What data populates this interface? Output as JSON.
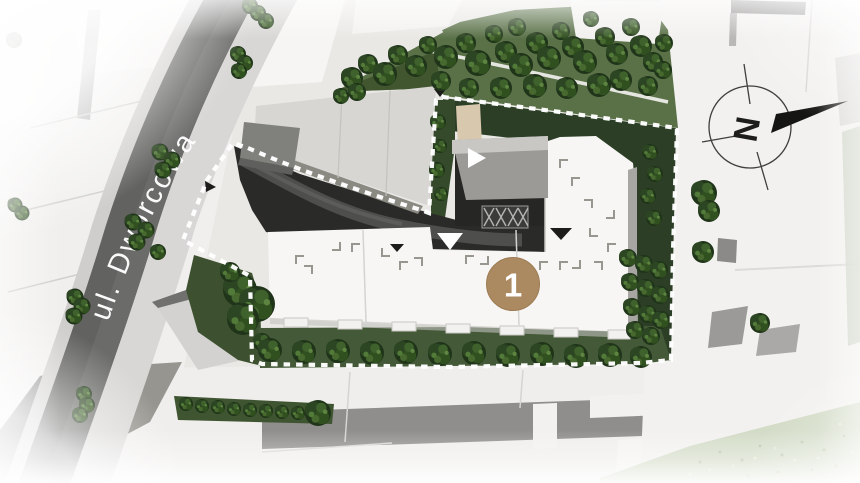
{
  "site_plan": {
    "street_label": "ul. Dworcowa",
    "compass": {
      "north_letter": "N"
    },
    "marker": {
      "number": "1"
    },
    "colors": {
      "marker_fill": "#ac8a61",
      "boundary_dash": "#ffffff",
      "asphalt": "#626260",
      "sidewalk": "#d8d7d5",
      "park_green": "#5a7148",
      "site_green_dark": "#2c3f26",
      "courtyard_dark": "#2a2a28",
      "building_white": "#f7f6f4"
    }
  }
}
